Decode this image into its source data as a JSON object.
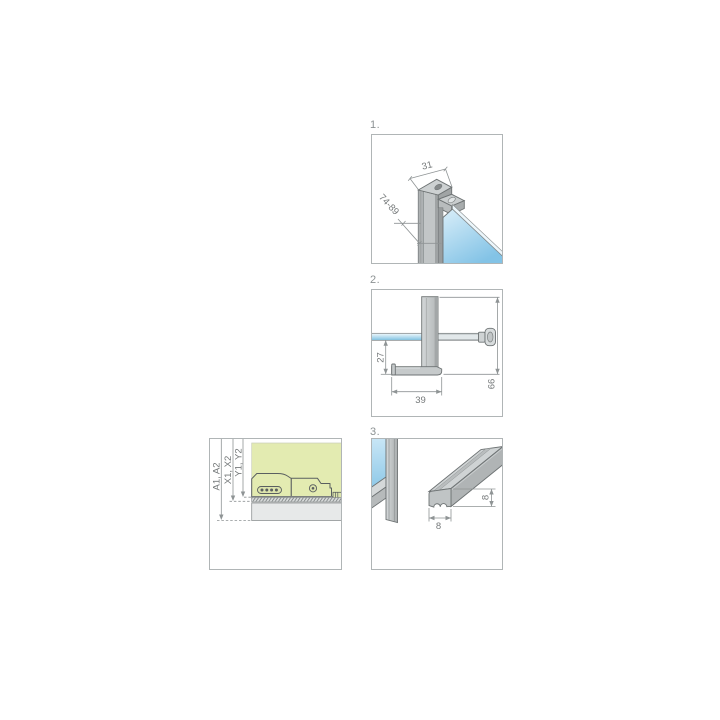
{
  "figure": {
    "steps": [
      {
        "label": "1.",
        "dim_width": "31",
        "dim_height_range": "74-89"
      },
      {
        "label": "2.",
        "dim_drop": "27",
        "dim_foot_width": "39",
        "dim_total_height": "66"
      },
      {
        "label": "3.",
        "dim_profile_width": "8",
        "dim_profile_height": "8"
      }
    ],
    "adjust_panel": {
      "dim_a": "A1, A2",
      "dim_x": "X1, X2",
      "dim_y": "Y1, Y2"
    }
  },
  "colors": {
    "glass_blue": "#8cc8e8",
    "glass_blue_light": "#d9eef9",
    "metal_gray": "#c6cacb",
    "metal_gray_dark": "#a0a4a5",
    "accent_green": "#e3ebb1",
    "dim_gray": "#8f9495",
    "panel_border": "#b0b5b6"
  }
}
